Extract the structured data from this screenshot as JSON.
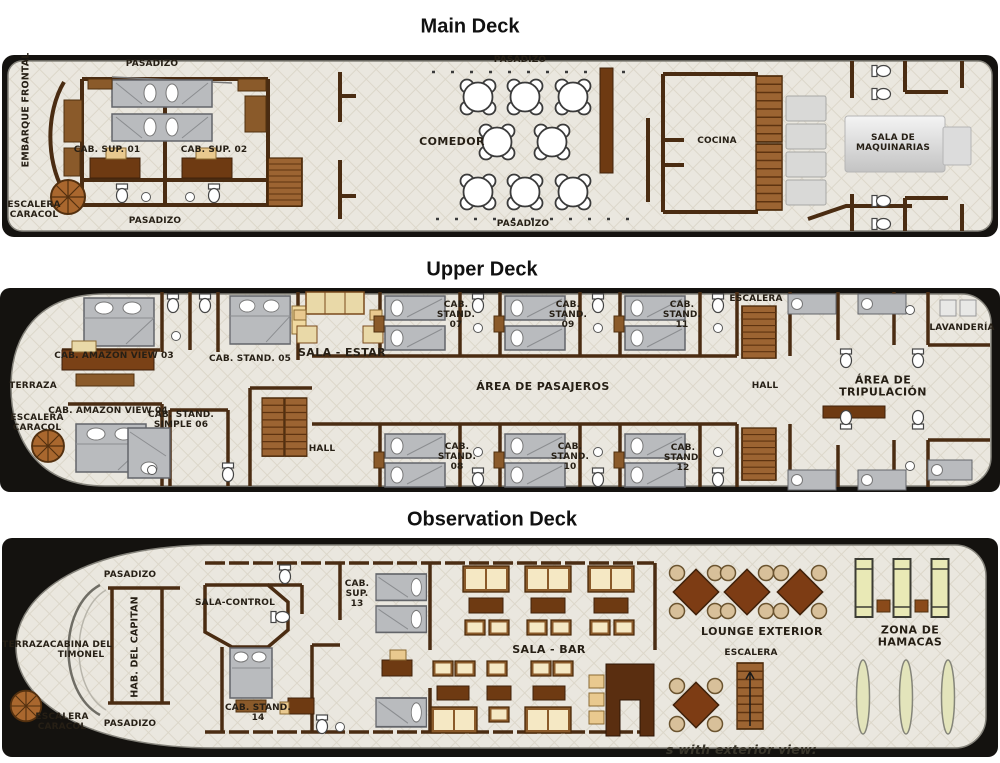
{
  "titles": {
    "main": "Main Deck",
    "upper": "Upper Deck",
    "observation": "Observation Deck"
  },
  "decks": {
    "main": {
      "labels": {
        "pasadizo_fore_top": "PASADIZO",
        "embarque_frontal": "EMBARQUE FRONTAL",
        "cab_sup_01": "CAB. SUP. 01",
        "cab_sup_02": "CAB. SUP. 02",
        "escalera_caracol": "ESCALERA\nCARACOL",
        "pasadizo_fore_bottom": "PASADIZO",
        "pasadizo_mid_top": "PASADIZO",
        "comedor": "COMEDOR",
        "pasadizo_mid_bottom": "PASADIZO",
        "cocina": "COCINA",
        "sala_de_maquinarias": "SALA DE MAQUINARIAS"
      }
    },
    "upper": {
      "labels": {
        "cab_amazon_view_03": "CAB. AMAZON VIEW 03",
        "cab_stand_05": "CAB. STAND. 05",
        "sala_estar": "SALA - ESTAR",
        "terraza": "TERRAZA",
        "cab_amazon_view_04": "CAB. AMAZON VIEW 04",
        "cab_stand_simple_06": "CAB. STAND.\nSIMPLE 06",
        "escalera_caracol": "ESCALERA\nCARACOL",
        "hall_port": "HALL",
        "cab_stand_07": "CAB.\nSTAND.\n07",
        "cab_stand_09": "CAB.\nSTAND.\n09",
        "cab_stand_11": "CAB.\nSTAND.\n11",
        "escalera": "ESCALERA",
        "lavanderia": "LAVANDERÍA",
        "area_de_pasajeros": "ÁREA DE PASAJEROS",
        "hall_aft": "HALL",
        "area_de_tripulacion": "ÁREA DE TRIPULACIÓN",
        "cab_stand_08": "CAB.\nSTAND.\n08",
        "cab_stand_10": "CAB.\nSTAND.\n10",
        "cab_stand_12": "CAB.\nSTAND.\n12"
      }
    },
    "observation": {
      "labels": {
        "pasadizo_top": "PASADIZO",
        "terraza": "TERRAZA",
        "cabina_del_timonel": "CABINA DEL\nTIMONEL",
        "hab_del_capitan": "HAB. DEL CAPITAN",
        "sala_control": "SALA-CONTROL",
        "escalera_caracol": "ESCALERA\nCARACOL",
        "pasadizo_bottom": "PASADIZO",
        "cab_sup_13": "CAB.\nSUP.\n13",
        "cab_stand_14": "CAB. STAND.\n14",
        "sala_bar": "SALA - BAR",
        "lounge_exterior": "LOUNGE EXTERIOR",
        "escalera": "ESCALERA",
        "zona_de_hamacas": "ZONA DE HAMACAS"
      }
    }
  },
  "watermark": "s with exterior view:",
  "colors": {
    "wall": "#4a2c12",
    "hull": "#14120f",
    "floor": "#eae7df",
    "floor_grid": "#dcd7ca",
    "wood_dark": "#6e3a12",
    "wood_mid": "#8a5a2a",
    "bed_gray": "#b9bbbe",
    "cushion": "#f5e8c4",
    "machine_gray": "#d9d9d9",
    "lounger_green": "#e9e9b6",
    "hammock": "#e3e4bb"
  }
}
